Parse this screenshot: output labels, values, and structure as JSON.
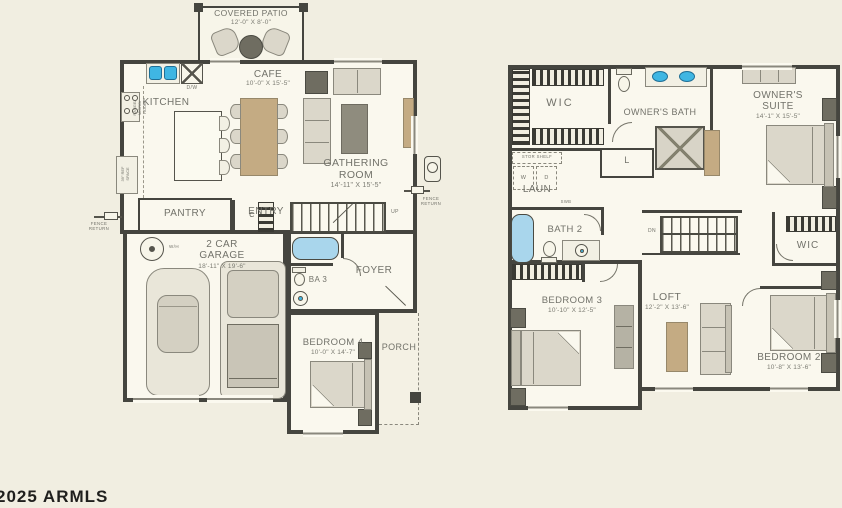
{
  "watermark": "2025 ARMLS",
  "colors": {
    "background": "#f1eee1",
    "wall": "#45453f",
    "label_text": "#72726a",
    "tub_blue": "#a9d6ec",
    "sink_blue": "#3fb6e3",
    "wood_tan": "#c4ab83"
  },
  "first_floor": {
    "covered_patio": {
      "label": "COVERED PATIO",
      "dims": "12'-0\" X 8'-0\""
    },
    "kitchen": {
      "label": "KITCHEN",
      "range_note": "RANGE/\nMICRO/\nHOOD",
      "ref_note": "39\" REF\nSPACE",
      "dishwasher": "D/W"
    },
    "cafe": {
      "label": "CAFE",
      "dims": "10'-0\" X 15'-5\""
    },
    "gathering_room": {
      "label": "GATHERING ROOM",
      "dims": "14'-11\" X 15'-5\""
    },
    "pantry": {
      "label": "PANTRY"
    },
    "entry": {
      "label": "ENTRY",
      "closet": "C"
    },
    "stairs_up": "UP",
    "garage": {
      "label": "2 CAR GARAGE",
      "dims": "18'-11\" X 19'-6\"",
      "water_heater": "W/H"
    },
    "ba3": {
      "label": "BA 3"
    },
    "foyer": {
      "label": "FOYER"
    },
    "bedroom4": {
      "label": "BEDROOM 4",
      "dims": "10'-0\" X 14'-7\""
    },
    "porch": {
      "label": "PORCH"
    },
    "fence_left": "FENCE\nRETURN",
    "fence_right": "FENCE\nRETURN"
  },
  "second_floor": {
    "wic1": {
      "label": "WIC"
    },
    "owners_bath": {
      "label": "OWNER'S BATH"
    },
    "owners_suite": {
      "label": "OWNER'S SUITE",
      "dims": "14'-1\" X 15'-5\""
    },
    "laundry": {
      "label": "LAUN",
      "stor_shelf": "STOR SHELF",
      "washer": "W",
      "dryer": "D"
    },
    "linen": "L",
    "swb": "SWB",
    "bath2": {
      "label": "BATH 2"
    },
    "stairs_dn": "DN",
    "wic2": {
      "label": "WIC"
    },
    "bedroom3": {
      "label": "BEDROOM 3",
      "dims": "10'-10\" X 12'-5\""
    },
    "loft": {
      "label": "LOFT",
      "dims": "12'-2\" X 13'-6\""
    },
    "bedroom2": {
      "label": "BEDROOM 2",
      "dims": "10'-8\" X 13'-6\""
    }
  }
}
